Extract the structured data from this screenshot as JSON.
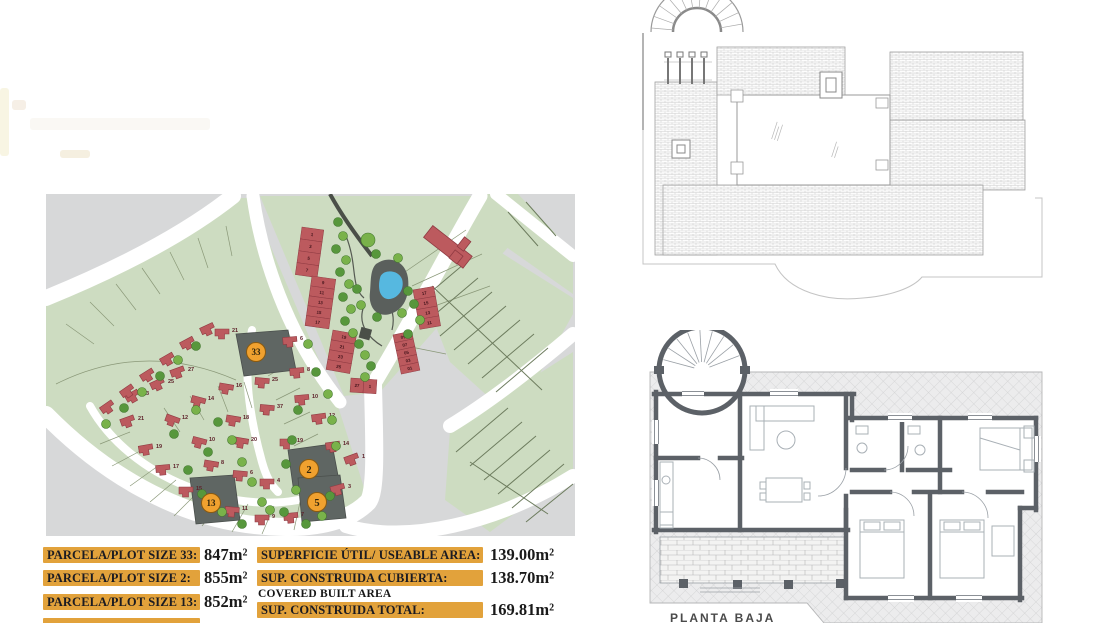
{
  "tables": {
    "plots": {
      "rows": [
        {
          "label": "PARCELA/PLOT SIZE 33:",
          "value": "847m²"
        },
        {
          "label": "PARCELA/PLOT SIZE 2:",
          "value": "855m²"
        },
        {
          "label": "PARCELA/PLOT SIZE 13:",
          "value": "852m²"
        }
      ]
    },
    "areas": {
      "rows": [
        {
          "label": "SUPERFICIE ÚTIL/ USEABLE AREA:",
          "value": "139.00m²",
          "sublabel": ""
        },
        {
          "label": "SUP. CONSTRUIDA CUBIERTA:",
          "value": "138.70m²",
          "sublabel": "COVERED BUILT AREA"
        },
        {
          "label": "SUP. CONSTRUIDA TOTAL:",
          "value": "169.81m²",
          "sublabel": ""
        }
      ]
    }
  },
  "floor_plan": {
    "ground_label": "PLANTA BAJA"
  },
  "site_plan": {
    "colors": {
      "green": "#cddcc1",
      "gray": "#d7d8d9",
      "road": "#ffffff",
      "house": "#bc5a5e",
      "house_edge": "#8f3a42",
      "plot_line": "#8a9878",
      "dark_plot": "#5f6663",
      "marker_fill": "#f0a12f",
      "marker_edge": "#8a5a10",
      "pond": "#56b8e0",
      "pond_edge": "#5a5f5c",
      "tree_a": "#79b24a",
      "tree_b": "#57973c",
      "tree_edge": "#42772e",
      "table_bar": "#e2a23b"
    },
    "highlight_markers": [
      {
        "label": "33",
        "x": 210,
        "y": 158
      },
      {
        "label": "2",
        "x": 263,
        "y": 275
      },
      {
        "label": "13",
        "x": 165,
        "y": 309
      },
      {
        "label": "5",
        "x": 271,
        "y": 308
      }
    ],
    "terrace_rows": [
      {
        "x": 256,
        "y": 33,
        "cw": 22,
        "ch": 12,
        "angle": 8,
        "vertical": true,
        "cells": [
          "1",
          "3",
          "5",
          "7"
        ]
      },
      {
        "x": 266,
        "y": 82,
        "cw": 24,
        "ch": 10,
        "angle": 8,
        "vertical": true,
        "cells": [
          "9",
          "11",
          "13",
          "15",
          "17"
        ]
      },
      {
        "x": 287,
        "y": 136,
        "cw": 24,
        "ch": 10,
        "angle": 10,
        "vertical": true,
        "cells": [
          "19",
          "21",
          "23",
          "25"
        ]
      },
      {
        "x": 305,
        "y": 184,
        "cw": 13,
        "ch": 14,
        "angle": 4,
        "vertical": false,
        "cells": [
          "27",
          "1"
        ]
      },
      {
        "x": 367,
        "y": 96,
        "cw": 21,
        "ch": 10,
        "angle": -10,
        "vertical": true,
        "cells": [
          "17",
          "15",
          "13",
          "11"
        ]
      },
      {
        "x": 347,
        "y": 141,
        "cw": 19,
        "ch": 8,
        "angle": -12,
        "vertical": true,
        "cells": [
          "09",
          "07",
          "05",
          "03",
          "01"
        ]
      }
    ],
    "houses": [
      {
        "x": 132,
        "y": 179,
        "a": -20,
        "n": "27"
      },
      {
        "x": 112,
        "y": 191,
        "a": -25,
        "n": "25"
      },
      {
        "x": 87,
        "y": 203,
        "a": -30,
        "n": "23"
      },
      {
        "x": 82,
        "y": 228,
        "a": -20,
        "n": "21"
      },
      {
        "x": 100,
        "y": 256,
        "a": -10,
        "n": "19"
      },
      {
        "x": 117,
        "y": 276,
        "a": -5,
        "n": "17"
      },
      {
        "x": 140,
        "y": 298,
        "a": 0,
        "n": "15"
      },
      {
        "x": 186,
        "y": 318,
        "a": 5,
        "n": "11"
      },
      {
        "x": 216,
        "y": 326,
        "a": 0,
        "n": "9"
      },
      {
        "x": 245,
        "y": 324,
        "a": -5,
        "n": "7"
      },
      {
        "x": 292,
        "y": 296,
        "a": -15,
        "n": "3"
      },
      {
        "x": 306,
        "y": 266,
        "a": -20,
        "n": "1"
      },
      {
        "x": 180,
        "y": 195,
        "a": 10,
        "n": "16"
      },
      {
        "x": 152,
        "y": 208,
        "a": 15,
        "n": "14"
      },
      {
        "x": 126,
        "y": 227,
        "a": 20,
        "n": "12"
      },
      {
        "x": 187,
        "y": 227,
        "a": 10,
        "n": "18"
      },
      {
        "x": 153,
        "y": 249,
        "a": 15,
        "n": "10"
      },
      {
        "x": 195,
        "y": 249,
        "a": 10,
        "n": "20"
      },
      {
        "x": 165,
        "y": 272,
        "a": 10,
        "n": "8"
      },
      {
        "x": 194,
        "y": 282,
        "a": 5,
        "n": "6"
      },
      {
        "x": 221,
        "y": 290,
        "a": 0,
        "n": "4"
      },
      {
        "x": 216,
        "y": 189,
        "a": 5,
        "n": "25"
      },
      {
        "x": 221,
        "y": 216,
        "a": 5,
        "n": "37"
      },
      {
        "x": 241,
        "y": 250,
        "a": 0,
        "n": "19"
      },
      {
        "x": 273,
        "y": 225,
        "a": -8,
        "n": "12"
      },
      {
        "x": 256,
        "y": 206,
        "a": -5,
        "n": "10"
      },
      {
        "x": 251,
        "y": 179,
        "a": -5,
        "n": "8"
      },
      {
        "x": 244,
        "y": 148,
        "a": -5,
        "n": "6"
      },
      {
        "x": 287,
        "y": 253,
        "a": -8,
        "n": "14"
      },
      {
        "x": 176,
        "y": 140,
        "a": 0,
        "n": "21"
      },
      {
        "x": 62,
        "y": 214,
        "a": -35
      },
      {
        "x": 82,
        "y": 198,
        "a": -35
      },
      {
        "x": 102,
        "y": 182,
        "a": -32
      },
      {
        "x": 122,
        "y": 166,
        "a": -30
      },
      {
        "x": 142,
        "y": 150,
        "a": -28
      },
      {
        "x": 162,
        "y": 136,
        "a": -25
      }
    ],
    "trees": [
      [
        292,
        28
      ],
      [
        297,
        42
      ],
      [
        290,
        55
      ],
      [
        300,
        66
      ],
      [
        294,
        78
      ],
      [
        303,
        90
      ],
      [
        297,
        103
      ],
      [
        305,
        115
      ],
      [
        299,
        127
      ],
      [
        307,
        139
      ],
      [
        313,
        150
      ],
      [
        319,
        161
      ],
      [
        325,
        172
      ],
      [
        319,
        183
      ],
      [
        330,
        60
      ],
      [
        352,
        64
      ],
      [
        362,
        97
      ],
      [
        356,
        119
      ],
      [
        331,
        123
      ],
      [
        315,
        111
      ],
      [
        311,
        95
      ],
      [
        322,
        46,
        7
      ],
      [
        368,
        110
      ],
      [
        374,
        126
      ],
      [
        362,
        140
      ],
      [
        262,
        150
      ],
      [
        270,
        178
      ],
      [
        282,
        200
      ],
      [
        252,
        216
      ],
      [
        286,
        226
      ],
      [
        246,
        246
      ],
      [
        290,
        252
      ],
      [
        240,
        270
      ],
      [
        250,
        296
      ],
      [
        284,
        302
      ],
      [
        276,
        322
      ],
      [
        238,
        318
      ],
      [
        150,
        216
      ],
      [
        172,
        228
      ],
      [
        186,
        246
      ],
      [
        162,
        258
      ],
      [
        196,
        268
      ],
      [
        142,
        276
      ],
      [
        206,
        288
      ],
      [
        156,
        300
      ],
      [
        216,
        308
      ],
      [
        128,
        240
      ],
      [
        60,
        230
      ],
      [
        78,
        214
      ],
      [
        96,
        198
      ],
      [
        114,
        182
      ],
      [
        132,
        166
      ],
      [
        150,
        152
      ],
      [
        176,
        318
      ],
      [
        196,
        330
      ],
      [
        224,
        316
      ],
      [
        260,
        330
      ]
    ]
  }
}
